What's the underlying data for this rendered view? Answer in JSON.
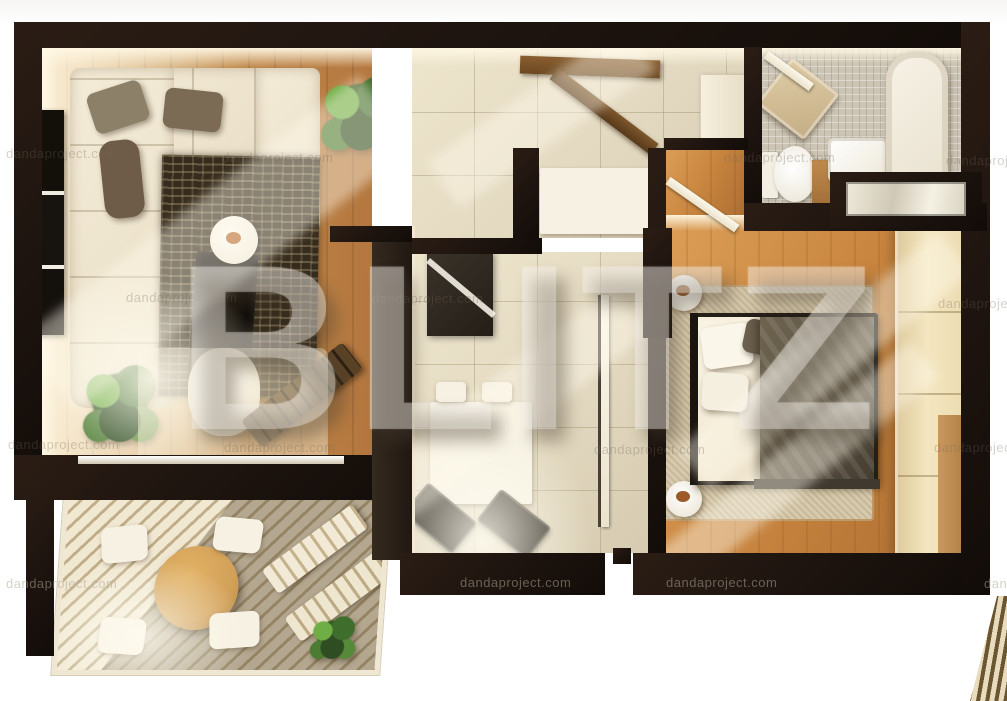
{
  "watermark": {
    "brand": "BLITZ",
    "site": "dandaproject.com"
  },
  "scene": {
    "type": "3d-apartment-floor-plan-render",
    "rooms": [
      "living-room",
      "hallway",
      "bathroom",
      "kitchen-dining",
      "bedroom",
      "balcony-terrace"
    ]
  },
  "palette": {
    "wall": "#1f1510",
    "wall-face": "#f7eed8",
    "wood-living": "#b4773f",
    "wood-bedroom": "#c8853f",
    "tile": "#e3d9c1",
    "mosaic": "#ccc4b4",
    "sofa": "#ece2cb",
    "rug-living": "#362c1e",
    "rug-bedroom": "#d7caac",
    "blanket": "#5c5342",
    "wardrobe": "#eddcb2",
    "deck-light": "#f1e8d2",
    "deck-gap": "#bfae89",
    "table-wood": "#d2a158",
    "plant-green": "#4c7c34",
    "food-accent": "#b96b2e",
    "white-furniture": "#f6f1e2"
  }
}
